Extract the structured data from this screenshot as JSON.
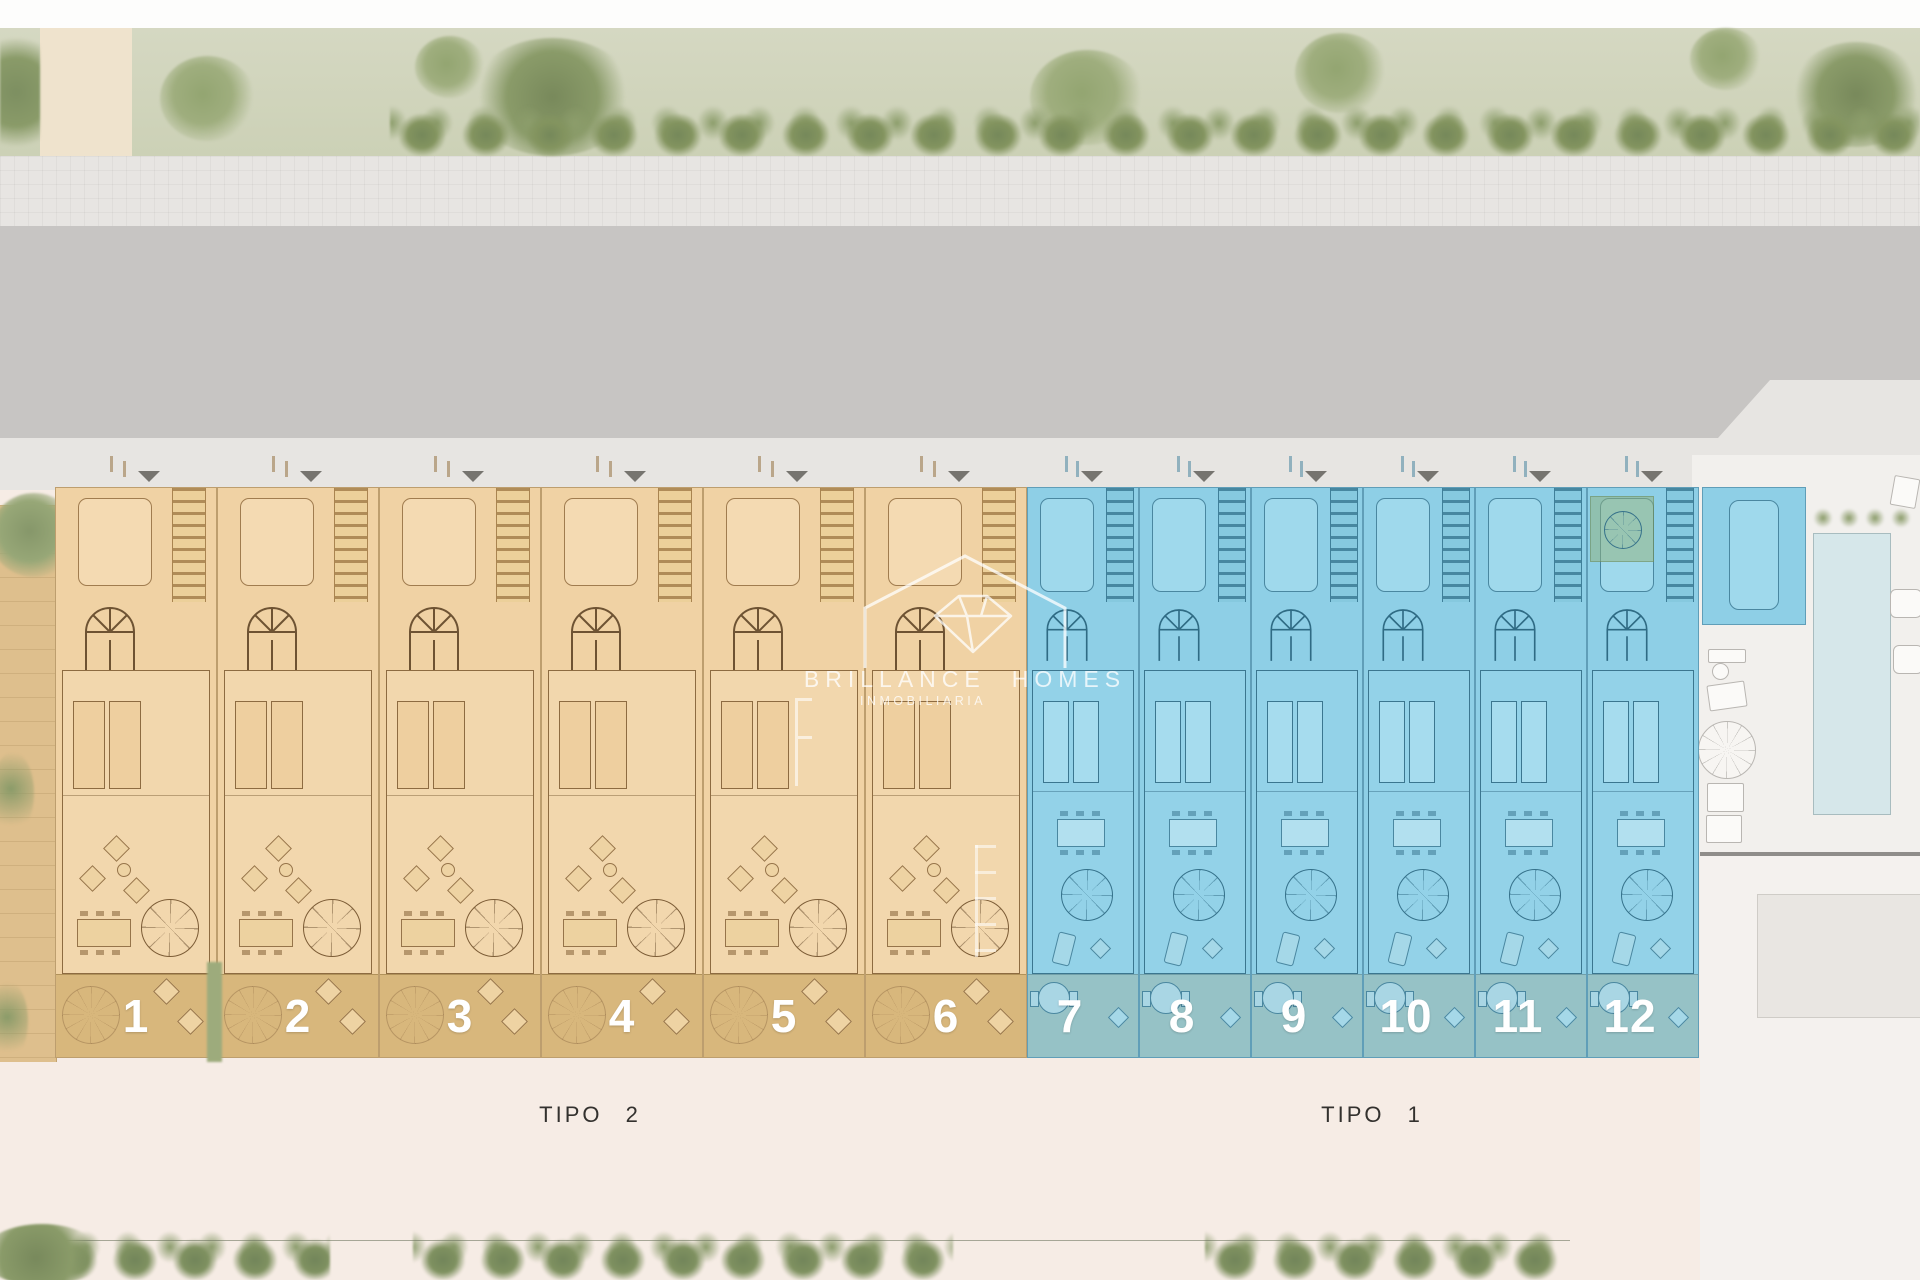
{
  "site_plan": {
    "watermark": {
      "brand_word1": "BRILLANCE",
      "brand_word2": "HOMES",
      "brand_sub": "INMOBILIARIA",
      "logo_icon": "house-with-diamond"
    },
    "type_labels": [
      {
        "id": "tipo2",
        "label": "TIPO 2"
      },
      {
        "id": "tipo1",
        "label": "TIPO 1"
      }
    ],
    "units": [
      {
        "number": "1",
        "type": "tipo-2"
      },
      {
        "number": "2",
        "type": "tipo-2"
      },
      {
        "number": "3",
        "type": "tipo-2"
      },
      {
        "number": "4",
        "type": "tipo-2"
      },
      {
        "number": "5",
        "type": "tipo-2"
      },
      {
        "number": "6",
        "type": "tipo-2"
      },
      {
        "number": "7",
        "type": "tipo-1"
      },
      {
        "number": "8",
        "type": "tipo-1"
      },
      {
        "number": "9",
        "type": "tipo-1"
      },
      {
        "number": "10",
        "type": "tipo-1"
      },
      {
        "number": "11",
        "type": "tipo-1"
      },
      {
        "number": "12",
        "type": "tipo-1",
        "has_patio": true
      }
    ],
    "colors": {
      "tipo2_fill": "#f0d2a4",
      "tipo2_garden": "#d8b77c",
      "tipo1_fill": "#8ecfe6",
      "tipo1_garden": "#96c2c6",
      "road": "#c7c5c3",
      "sidewalk": "#e7e5e2",
      "paving": "#f6ece5",
      "pool": "#d6e7ea",
      "landscape_green": "#ccd1b6",
      "unit_number_text": "#ffffff",
      "type_label_text": "#33312e"
    }
  }
}
